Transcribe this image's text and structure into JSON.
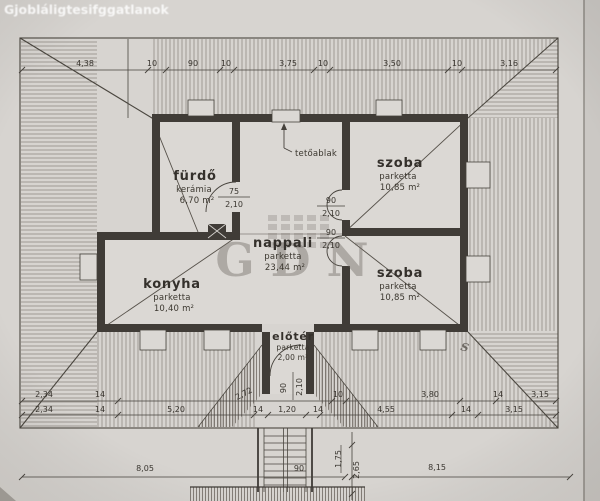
{
  "scan": {
    "top_watermark": "Gjobláligtesifggatlanok",
    "center_watermark": "GDN",
    "mark": "S"
  },
  "rooms": {
    "furdo": {
      "name": "fürdő",
      "floor": "kerámia",
      "area": "6,70 m²"
    },
    "szoba_top": {
      "name": "szoba",
      "floor": "parketta",
      "area": "10,85 m²"
    },
    "nappali": {
      "name": "nappali",
      "floor": "parketta",
      "area": "23,44 m²"
    },
    "konyha": {
      "name": "konyha",
      "floor": "parketta",
      "area": "10,40 m²"
    },
    "szoba_bottom": {
      "name": "szoba",
      "floor": "parketta",
      "area": "10,85 m²"
    },
    "eloter": {
      "name": "előtér",
      "floor": "parketta",
      "area": "2,00 m²"
    }
  },
  "annotations": {
    "roof_window": "tetőablak"
  },
  "doors": {
    "furdo": {
      "w": "75",
      "h": "2,10"
    },
    "szoba_top": {
      "w": "90",
      "h": "2,10"
    },
    "szoba_bottom": {
      "w": "90",
      "h": "2,10"
    },
    "eloter": {
      "w": "90",
      "h": "2,10"
    }
  },
  "dims": {
    "top": [
      "4,38",
      "10",
      "90",
      "10",
      "3,75",
      "10",
      "3,50",
      "10",
      "3,16"
    ],
    "row_a": [
      "2,34",
      "14",
      "2,72",
      "10",
      "3,80",
      "14",
      "3,15"
    ],
    "row_b": [
      "2,34",
      "14",
      "5,20",
      "14",
      "1,20",
      "14",
      "4,55",
      "14",
      "3,15"
    ],
    "bottom": [
      "8,05",
      "90",
      "8,15"
    ],
    "vertical": [
      "1,75",
      "2,65"
    ]
  }
}
